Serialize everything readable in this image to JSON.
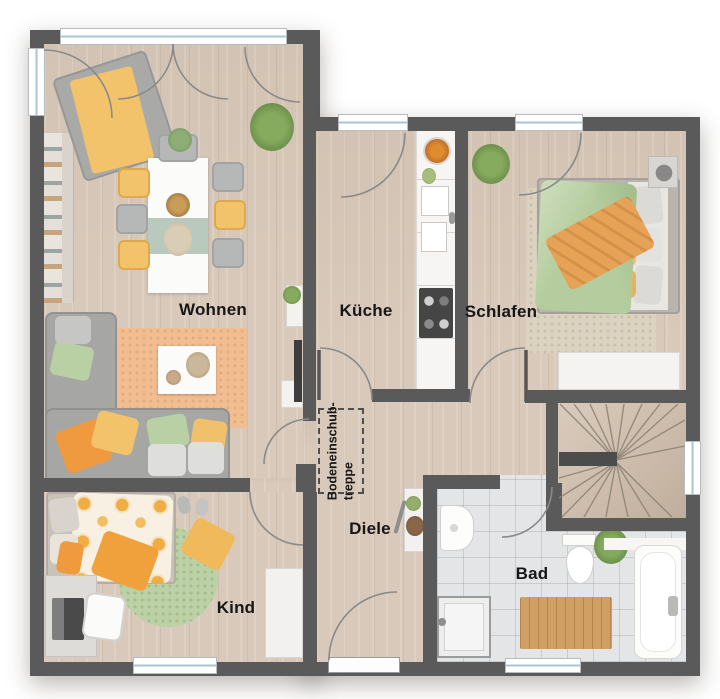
{
  "image_type": "architectural floor plan (top-down rendered)",
  "rooms": {
    "wohnen": {
      "label": "Wohnen"
    },
    "kueche": {
      "label": "Küche"
    },
    "schlafen": {
      "label": "Schlafen"
    },
    "diele": {
      "label": "Diele"
    },
    "bad": {
      "label": "Bad"
    },
    "kind": {
      "label": "Kind"
    },
    "attic_stairs": {
      "label_line1": "Bodeneinschub-",
      "label_line2": "treppe"
    }
  },
  "colors": {
    "wall": "#5a5a5a",
    "wood_floor": "#d8c9ba",
    "tile_floor": "#e4e5e7",
    "window_glass": "#a9c4d4",
    "accent_orange": "#ef9a3f",
    "accent_yellow": "#f2c36b",
    "accent_green": "#b5cd9e",
    "label_text": "#161616"
  }
}
